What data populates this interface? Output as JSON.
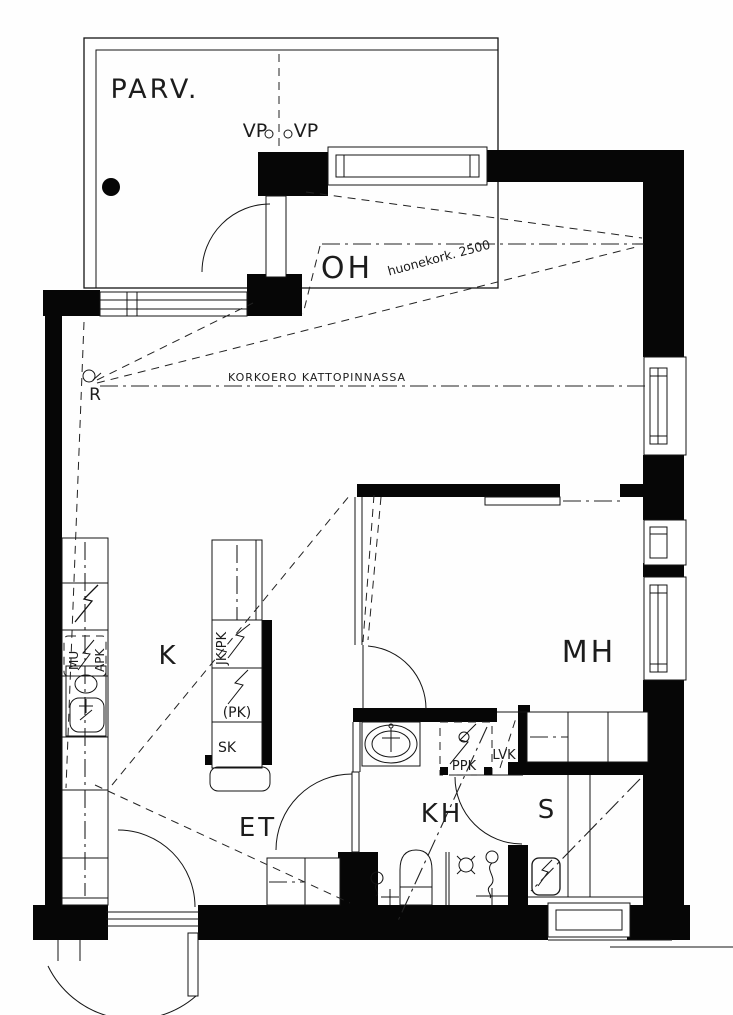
{
  "drawing_type": "apartment floor plan",
  "colors": {
    "line": "#000000",
    "background": "#ffffff"
  },
  "rooms": {
    "balcony": "PARV.",
    "living_room": "OH",
    "kitchen": "K",
    "bedroom": "MH",
    "hallway": "ET",
    "bathroom": "KH",
    "sauna": "S"
  },
  "markers": {
    "vp_left": "VP",
    "vp_right": "VP",
    "r_marker": "R"
  },
  "notes": {
    "ceiling_note": "KORKOERO KATTOPINNASSA",
    "room_height_note": "huonekork. 2500"
  },
  "appliances": {
    "fridge_freezer": "JK/PK",
    "dishwasher_reserved": "(PK)",
    "cleaning_cabinet": "SK",
    "oven": "MU",
    "dishwasher": "APK",
    "washer_reserved": "PPK",
    "water_heater": "LVK"
  }
}
